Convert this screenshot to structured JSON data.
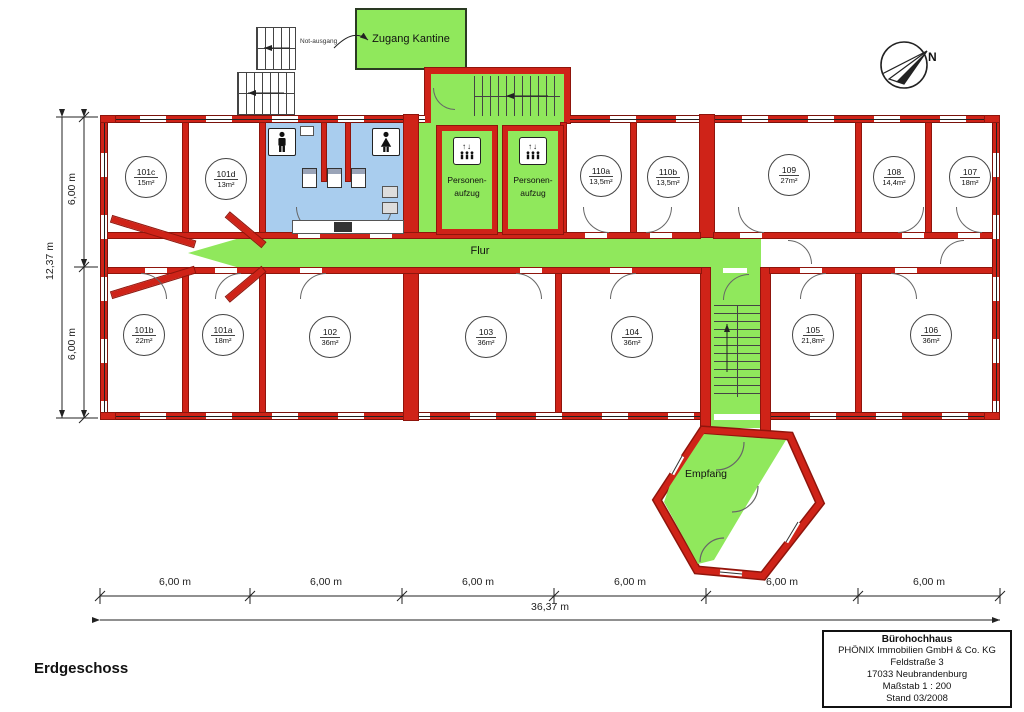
{
  "floor_label": "Erdgeschoss",
  "north_label": "N",
  "plan_labels": {
    "zugang_kantine": "Zugang Kantine",
    "not_ausgang": "Not-ausgang",
    "flur": "Flur",
    "empfang": "Empfang"
  },
  "elevator": {
    "line1": "Personen-",
    "line2": "aufzug",
    "arrows": "↑↓"
  },
  "rooms_top": [
    {
      "id": "101c",
      "area": "15m²"
    },
    {
      "id": "101d",
      "area": "13m²"
    },
    {
      "id": "110a",
      "area": "13,5m²"
    },
    {
      "id": "110b",
      "area": "13,5m²"
    },
    {
      "id": "109",
      "area": "27m²"
    },
    {
      "id": "108",
      "area": "14,4m²"
    },
    {
      "id": "107",
      "area": "18m²"
    }
  ],
  "rooms_bottom": [
    {
      "id": "101b",
      "area": "22m²"
    },
    {
      "id": "101a",
      "area": "18m²"
    },
    {
      "id": "102",
      "area": "36m²"
    },
    {
      "id": "103",
      "area": "36m²"
    },
    {
      "id": "104",
      "area": "36m²"
    },
    {
      "id": "105",
      "area": "21,8m²"
    },
    {
      "id": "106",
      "area": "36m²"
    }
  ],
  "dimensions": {
    "bottom_segments": [
      "6,00 m",
      "6,00 m",
      "6,00 m",
      "6,00 m",
      "6,00 m",
      "6,00 m"
    ],
    "bottom_total": "36,37 m",
    "left_segments": [
      "6,00 m",
      "6,00 m"
    ],
    "left_total": "12,37 m"
  },
  "title_block": {
    "building": "Bürohochhaus",
    "company": "PHÖNIX Immobilien GmbH & Co. KG",
    "street": "Feldstraße 3",
    "city": "17033 Neubrandenburg",
    "scale": "Maßstab 1 : 200",
    "stand": "Stand 03/2008"
  },
  "colors": {
    "wall_red": "#cf2318",
    "zone_green": "#90e85c",
    "wc_blue": "#a9cdee"
  }
}
